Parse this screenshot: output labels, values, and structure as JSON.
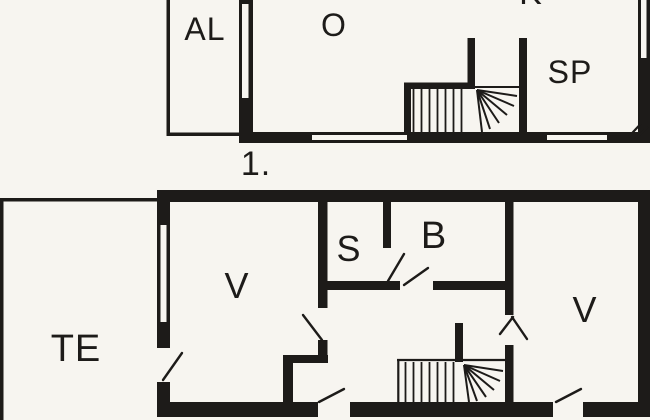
{
  "colors": {
    "background": "#f7f5f0",
    "wall": "#1d1b19"
  },
  "upper_floor": {
    "floor_label": "1.",
    "rooms": [
      {
        "id": "al",
        "label": "AL"
      },
      {
        "id": "o",
        "label": "O"
      },
      {
        "id": "k",
        "label": "K"
      },
      {
        "id": "sp",
        "label": "SP"
      }
    ]
  },
  "lower_floor": {
    "rooms": [
      {
        "id": "te",
        "label": "TE"
      },
      {
        "id": "v-left",
        "label": "V"
      },
      {
        "id": "s",
        "label": "S"
      },
      {
        "id": "b",
        "label": "B"
      },
      {
        "id": "v-right",
        "label": "V"
      }
    ]
  }
}
